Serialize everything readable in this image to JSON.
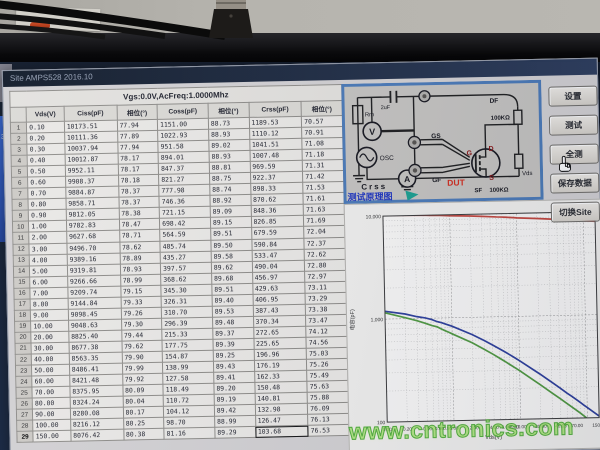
{
  "window": {
    "title": "Site AMPS528 2016.10"
  },
  "table": {
    "header_title": "Vgs:0.0V,AcFreq:1.0000Mhz",
    "columns": [
      "Vds(V)",
      "Ciss(pF)",
      "相位(°)",
      "Coss(pF)",
      "相位(°)",
      "Crss(pF)",
      "相位(°)"
    ],
    "rows": [
      [
        "0.10",
        "10173.51",
        "77.94",
        "1151.00",
        "88.73",
        "1189.53",
        "70.57"
      ],
      [
        "0.20",
        "10111.36",
        "77.89",
        "1022.93",
        "88.93",
        "1110.12",
        "70.91"
      ],
      [
        "0.30",
        "10037.94",
        "77.94",
        "951.58",
        "89.02",
        "1041.51",
        "71.08"
      ],
      [
        "0.40",
        "10012.87",
        "78.17",
        "894.01",
        "88.93",
        "1007.48",
        "71.18"
      ],
      [
        "0.50",
        "9952.11",
        "78.17",
        "847.37",
        "88.81",
        "969.59",
        "71.31"
      ],
      [
        "0.60",
        "9908.37",
        "78.18",
        "821.27",
        "88.75",
        "922.37",
        "71.42"
      ],
      [
        "0.70",
        "9884.87",
        "78.37",
        "777.98",
        "88.74",
        "898.33",
        "71.53"
      ],
      [
        "0.80",
        "9858.71",
        "78.37",
        "746.36",
        "88.92",
        "870.62",
        "71.61"
      ],
      [
        "0.90",
        "9812.05",
        "78.38",
        "721.15",
        "89.09",
        "848.36",
        "71.63"
      ],
      [
        "1.00",
        "9782.83",
        "78.47",
        "698.42",
        "89.15",
        "826.85",
        "71.69"
      ],
      [
        "2.00",
        "9627.68",
        "78.71",
        "564.59",
        "89.51",
        "679.59",
        "72.04"
      ],
      [
        "3.00",
        "9496.70",
        "78.62",
        "485.74",
        "89.50",
        "590.84",
        "72.37"
      ],
      [
        "4.00",
        "9389.16",
        "78.89",
        "435.27",
        "89.58",
        "533.47",
        "72.62"
      ],
      [
        "5.00",
        "9319.81",
        "78.93",
        "397.57",
        "89.62",
        "490.04",
        "72.80"
      ],
      [
        "6.00",
        "9266.66",
        "78.99",
        "368.62",
        "89.68",
        "456.97",
        "72.97"
      ],
      [
        "7.00",
        "9209.74",
        "79.15",
        "345.30",
        "89.51",
        "429.63",
        "73.11"
      ],
      [
        "8.00",
        "9144.84",
        "79.33",
        "326.31",
        "89.40",
        "406.95",
        "73.29"
      ],
      [
        "9.00",
        "9098.45",
        "79.26",
        "310.70",
        "89.53",
        "387.43",
        "73.38"
      ],
      [
        "10.00",
        "9048.63",
        "79.30",
        "296.39",
        "89.48",
        "370.34",
        "73.47"
      ],
      [
        "20.00",
        "8825.40",
        "79.44",
        "215.33",
        "89.37",
        "272.65",
        "74.12"
      ],
      [
        "30.00",
        "8677.38",
        "79.62",
        "177.75",
        "89.39",
        "225.65",
        "74.56"
      ],
      [
        "40.00",
        "8563.35",
        "79.90",
        "154.87",
        "89.25",
        "196.96",
        "75.03"
      ],
      [
        "50.00",
        "8486.41",
        "79.99",
        "138.99",
        "89.43",
        "176.19",
        "75.26"
      ],
      [
        "60.00",
        "8421.48",
        "79.92",
        "127.58",
        "89.41",
        "162.33",
        "75.49"
      ],
      [
        "70.00",
        "8375.95",
        "80.09",
        "118.49",
        "89.20",
        "150.48",
        "75.63"
      ],
      [
        "80.00",
        "8324.24",
        "80.04",
        "110.72",
        "89.19",
        "140.81",
        "75.88"
      ],
      [
        "90.00",
        "8280.08",
        "80.17",
        "104.12",
        "89.42",
        "132.98",
        "76.09"
      ],
      [
        "100.00",
        "8216.12",
        "80.25",
        "98.70",
        "88.99",
        "126.47",
        "76.13"
      ],
      [
        "150.00",
        "8076.42",
        "80.38",
        "81.16",
        "89.29",
        "103.68",
        "76.53"
      ]
    ],
    "selected": {
      "row": 29,
      "col": 5,
      "value": "103.68"
    }
  },
  "buttons": {
    "labels": [
      "设置",
      "测试",
      "全测",
      "保存数据",
      "切换Site"
    ],
    "cursor_on": "全测"
  },
  "diagram": {
    "rm": "Rm",
    "cap": "2uF",
    "v": "V",
    "osc": "OSC",
    "a": "A",
    "gs": "GS",
    "gf": "GF",
    "df": "DF",
    "sf": "SF",
    "d": "D",
    "g": "G",
    "s": "S",
    "dut": "DUT",
    "vds": "Vds",
    "r_top": "100KΩ",
    "r_bottom": "100KΩ",
    "crss": "Crss",
    "caption": "测试原理图"
  },
  "chart_data": {
    "type": "line",
    "x_label": "Vds(V)",
    "y_label": "电容(pF)",
    "x_scale": "log",
    "y_scale": "log",
    "x_range": [
      0.1,
      150
    ],
    "y_range": [
      100,
      10000
    ],
    "y_ticks": [
      "10,000",
      "1,000",
      "100"
    ],
    "x_ticks": [
      "0.10",
      "0.20",
      "0.40",
      "0.60",
      "0.80",
      "1.00",
      "2.00",
      "4.00",
      "6.00",
      "8.00",
      "10.00",
      "20.00",
      "40.00",
      "70.00",
      "150.00"
    ],
    "grid": true,
    "x": [
      0.1,
      0.2,
      0.3,
      0.4,
      0.5,
      0.6,
      0.7,
      0.8,
      0.9,
      1,
      2,
      3,
      4,
      5,
      6,
      7,
      8,
      9,
      10,
      20,
      30,
      40,
      50,
      60,
      70,
      80,
      90,
      100,
      150
    ],
    "series": [
      {
        "name": "Ciss",
        "color": "#c4453c",
        "values": [
          10173.51,
          10111.36,
          10037.94,
          10012.87,
          9952.11,
          9908.37,
          9884.87,
          9858.71,
          9812.05,
          9782.83,
          9627.68,
          9496.7,
          9389.16,
          9319.81,
          9266.66,
          9209.74,
          9144.84,
          9098.45,
          9048.63,
          8825.4,
          8677.38,
          8563.35,
          8486.41,
          8421.48,
          8375.95,
          8324.24,
          8280.08,
          8216.12,
          8076.42
        ]
      },
      {
        "name": "Crss",
        "color": "#2c3e9c",
        "values": [
          1189.53,
          1110.12,
          1041.51,
          1007.48,
          969.59,
          922.37,
          898.33,
          870.62,
          848.36,
          826.85,
          679.59,
          590.84,
          533.47,
          490.04,
          456.97,
          429.63,
          406.95,
          387.43,
          370.34,
          272.65,
          225.65,
          196.96,
          176.19,
          162.33,
          150.48,
          140.81,
          132.98,
          126.47,
          103.68
        ]
      },
      {
        "name": "Coss",
        "color": "#4f9a3f",
        "values": [
          1151.0,
          1022.93,
          951.58,
          894.01,
          847.37,
          821.27,
          777.98,
          746.36,
          721.15,
          698.42,
          564.59,
          485.74,
          435.27,
          397.57,
          368.62,
          345.3,
          326.31,
          310.7,
          296.39,
          215.33,
          177.75,
          154.87,
          138.99,
          127.58,
          118.49,
          110.72,
          104.12,
          98.7,
          81.16
        ]
      }
    ]
  },
  "watermark": "www.cntronics.com",
  "desktop_fragment": "34"
}
